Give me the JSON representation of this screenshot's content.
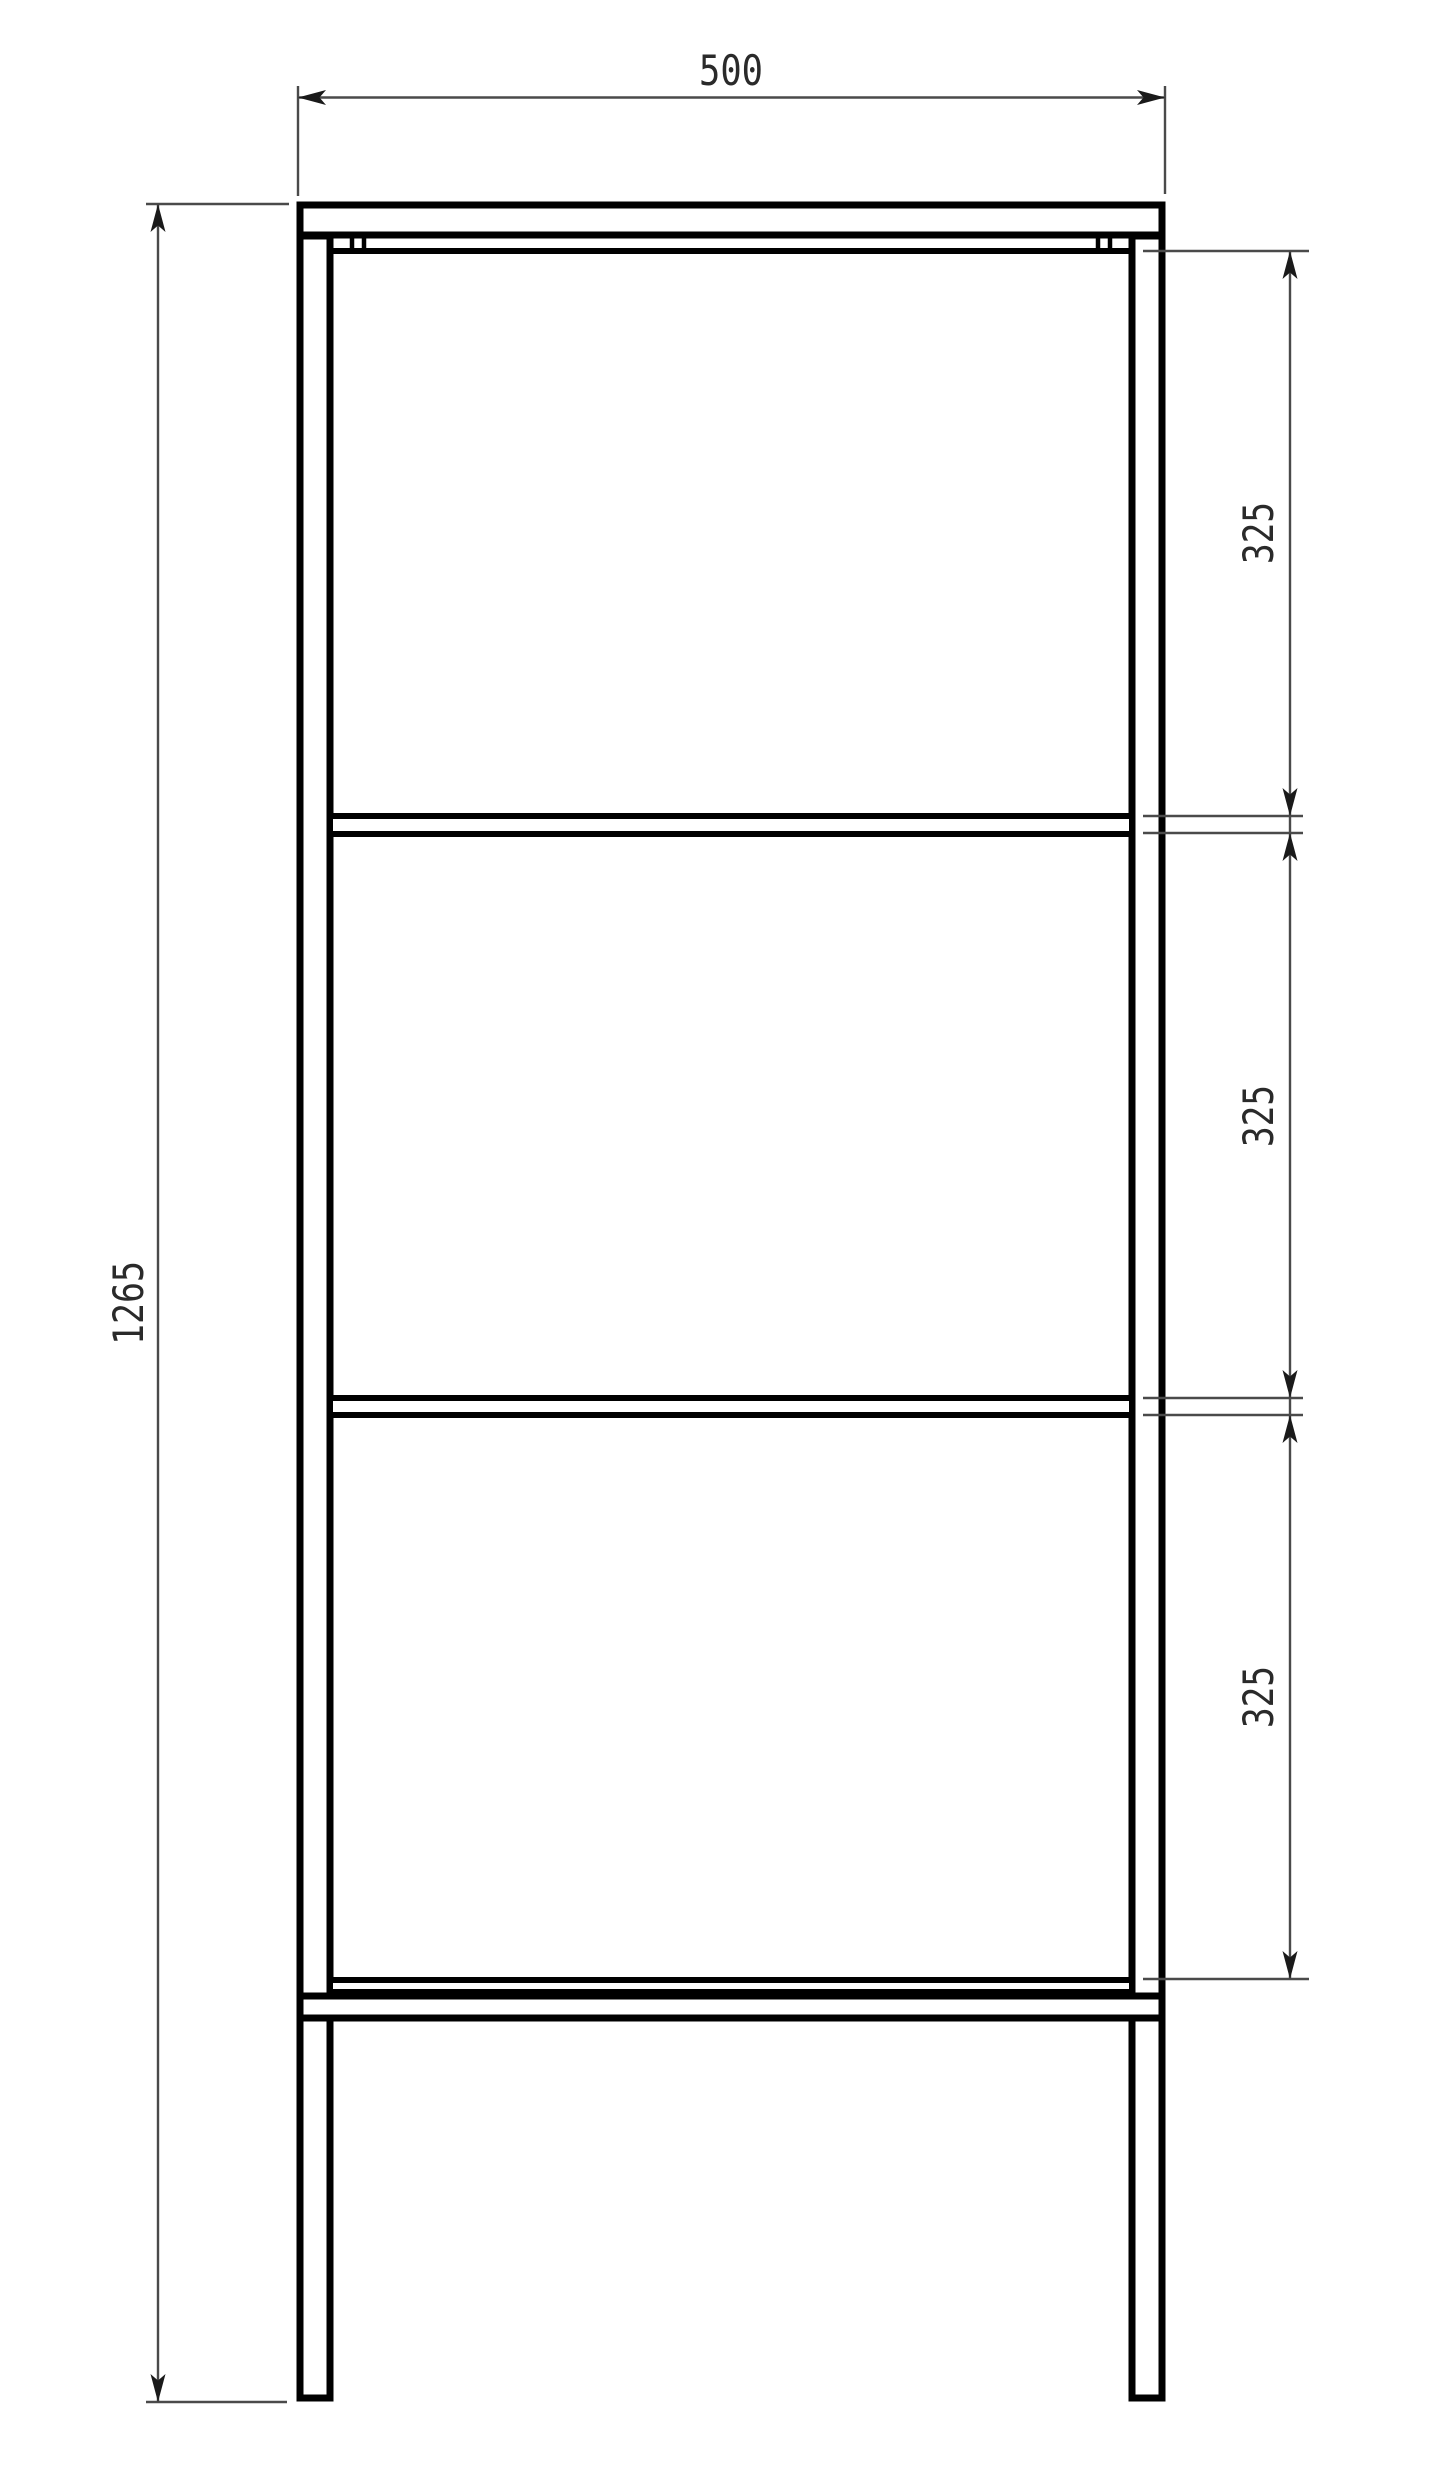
{
  "dimensions": {
    "width": "500",
    "height": "1265",
    "spacing_top": "325",
    "spacing_middle": "325",
    "spacing_bottom": "325"
  },
  "colors": {
    "frame": "#000000",
    "dimension_line": "#4a4a4a",
    "dimension_text": "#2a2a2a",
    "background": "#ffffff"
  }
}
